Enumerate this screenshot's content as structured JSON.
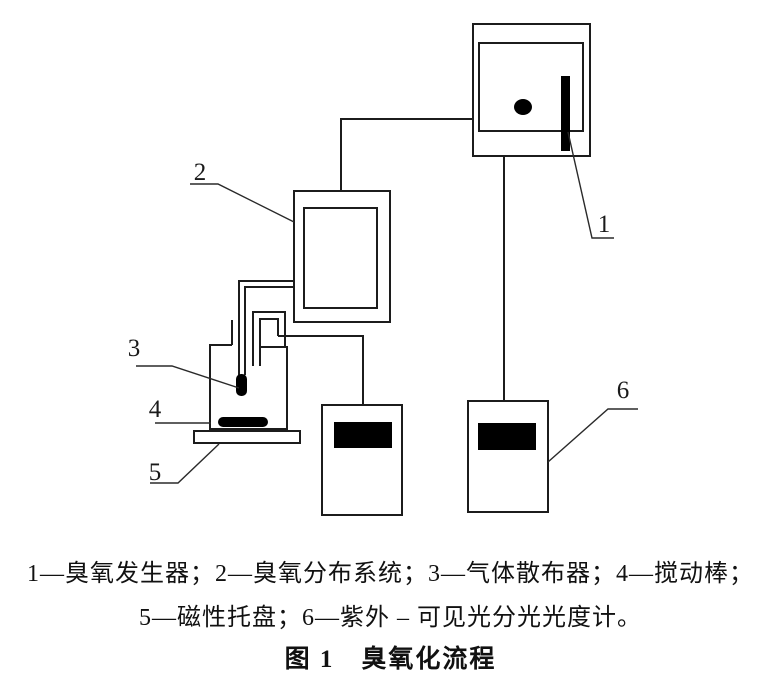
{
  "figure": {
    "part_labels": {
      "p1": "1",
      "p2": "2",
      "p3": "3",
      "p4": "4",
      "p5": "5",
      "p6": "6"
    },
    "legend": {
      "line1": "1—臭氧发生器；2—臭氧分布系统；3—气体散布器；4—搅动棒；",
      "line2": "5—磁性托盘；6—紫外 – 可见光分光光度计。"
    },
    "caption": "图 1　臭氧化流程",
    "components": [
      {
        "number": "1",
        "name": "臭氧发生器"
      },
      {
        "number": "2",
        "name": "臭氧分布系统"
      },
      {
        "number": "3",
        "name": "气体散布器"
      },
      {
        "number": "4",
        "name": "搅动棒"
      },
      {
        "number": "5",
        "name": "磁性托盘"
      },
      {
        "number": "6",
        "name": "紫外 – 可见光分光光度计"
      }
    ],
    "colors": {
      "line": "#1c1c1c",
      "solid_fill": "#000000",
      "background": "#ffffff"
    }
  }
}
